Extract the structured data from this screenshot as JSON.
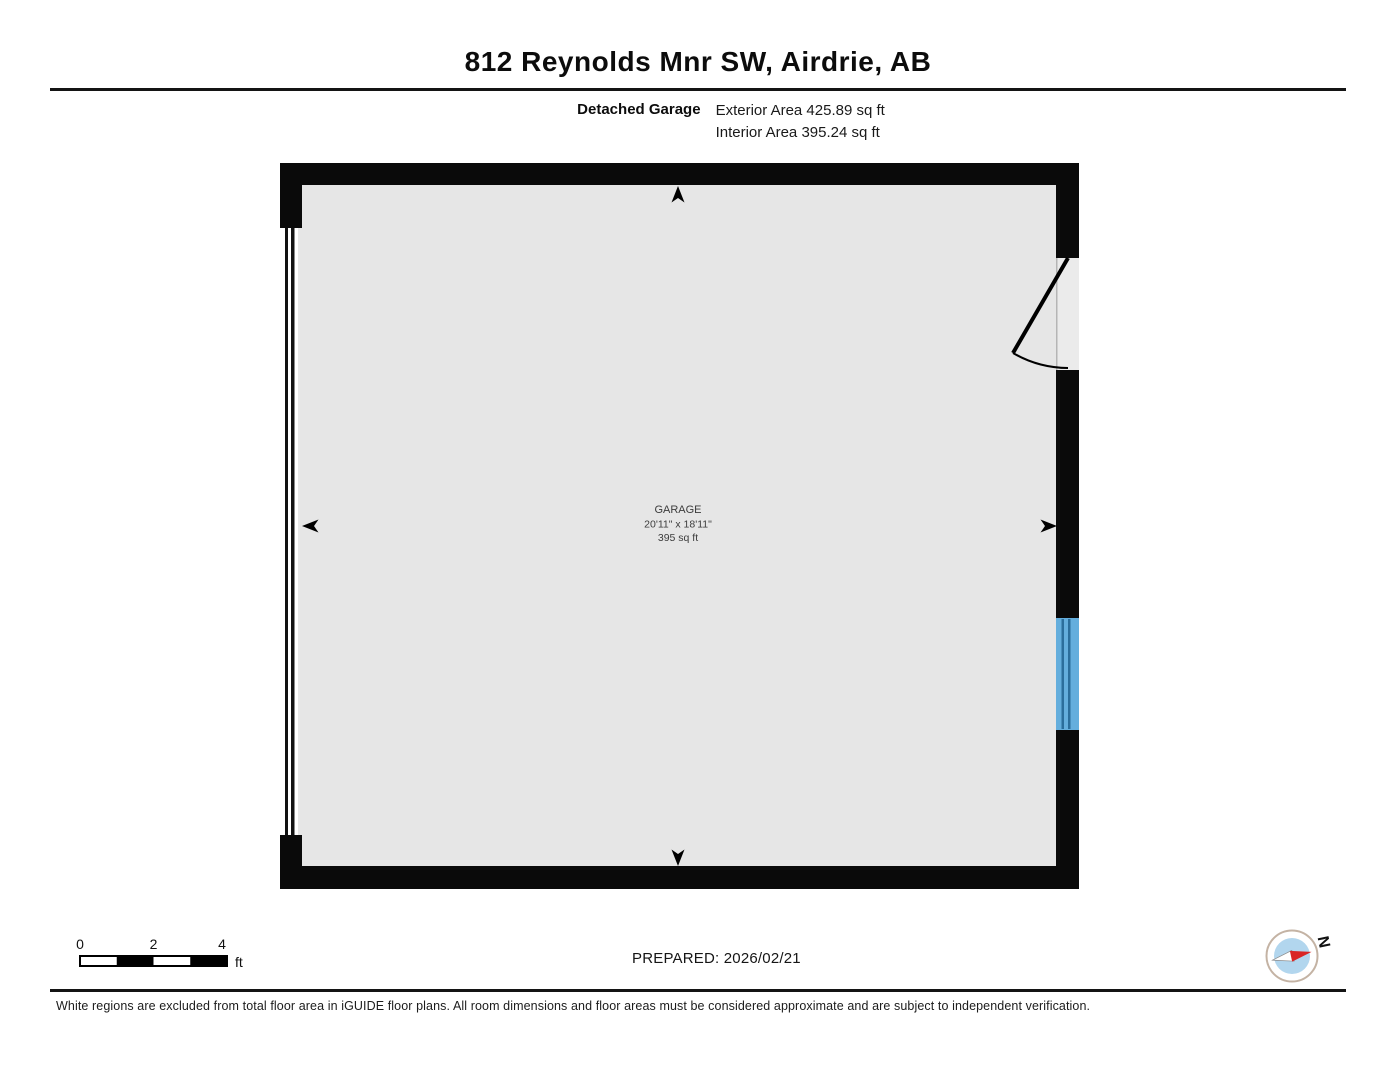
{
  "header": {
    "title": "812 Reynolds Mnr SW, Airdrie, AB"
  },
  "floor_info": {
    "name": "Detached Garage",
    "exterior_area": "Exterior Area 425.89 sq ft",
    "interior_area": "Interior Area 395.24 sq ft"
  },
  "room": {
    "name": "GARAGE",
    "dimensions": "20'11\" x 18'11\"",
    "area": "395 sq ft"
  },
  "scale_bar": {
    "ticks": [
      "0",
      "2",
      "4"
    ],
    "unit": "ft"
  },
  "footer": {
    "prepared": "PREPARED: 2026/02/21",
    "disclaimer": "White regions are excluded from total floor area in iGUIDE floor plans. All room dimensions and floor areas must be considered approximate and are subject to independent verification."
  },
  "compass": {
    "north_label": "N"
  },
  "colors": {
    "wall_black": "#0a0a0a",
    "floor_gray": "#e6e6e6",
    "window_blue": "#64aedd",
    "window_frame_blue": "#2b6e9c",
    "compass_ring": "#c4b3a4",
    "compass_blue": "#b2d6ee",
    "compass_red": "#d92525"
  }
}
